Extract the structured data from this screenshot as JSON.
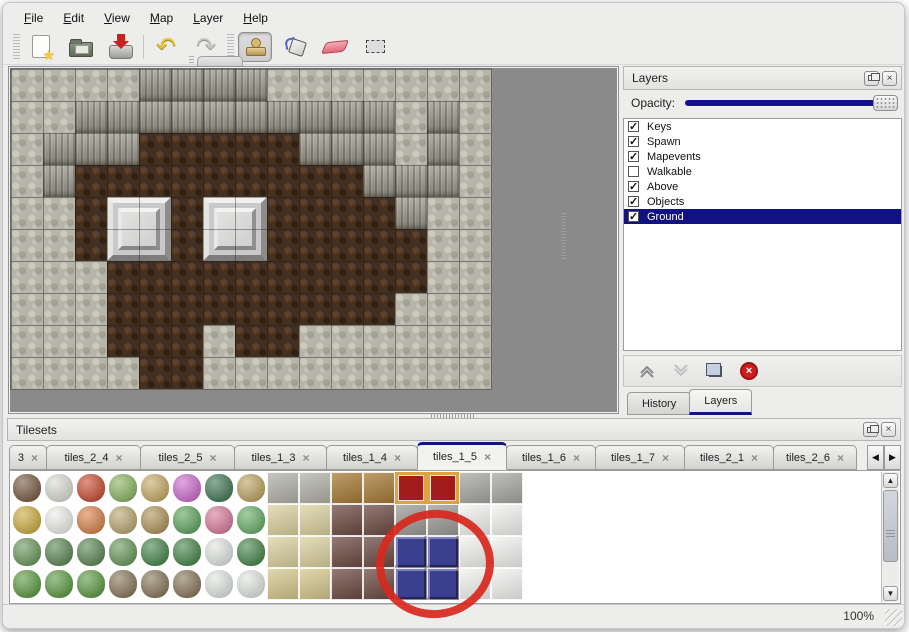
{
  "menu": {
    "items": [
      "File",
      "Edit",
      "View",
      "Map",
      "Layer",
      "Help"
    ]
  },
  "toolbar": {
    "groups": [
      {
        "buttons": [
          {
            "icon": "new-file"
          },
          {
            "icon": "open-folder"
          },
          {
            "icon": "save"
          }
        ]
      },
      {
        "buttons": [
          {
            "icon": "undo"
          },
          {
            "icon": "redo"
          }
        ]
      },
      {
        "buttons": [
          {
            "icon": "stamp",
            "active": true
          },
          {
            "icon": "fill"
          },
          {
            "icon": "eraser"
          },
          {
            "icon": "select"
          }
        ]
      }
    ]
  },
  "layers_panel": {
    "title": "Layers",
    "opacity_label": "Opacity:",
    "opacity_value_pct": 100,
    "layers": [
      {
        "name": "Keys",
        "checked": true,
        "selected": false
      },
      {
        "name": "Spawn",
        "checked": true,
        "selected": false
      },
      {
        "name": "Mapevents",
        "checked": true,
        "selected": false
      },
      {
        "name": "Walkable",
        "checked": false,
        "selected": false
      },
      {
        "name": "Above",
        "checked": true,
        "selected": false
      },
      {
        "name": "Objects",
        "checked": true,
        "selected": false
      },
      {
        "name": "Ground",
        "checked": true,
        "selected": true
      }
    ],
    "buttons": [
      {
        "icon": "move-layer-up",
        "enabled": true
      },
      {
        "icon": "move-layer-down",
        "enabled": false
      },
      {
        "icon": "duplicate-layer",
        "enabled": true
      },
      {
        "icon": "delete-layer",
        "enabled": true
      }
    ],
    "bottom_tabs": [
      {
        "label": "History",
        "active": false
      },
      {
        "label": "Layers",
        "active": true
      }
    ],
    "selected_color": "#111184",
    "opacity_track_color": "#12128c"
  },
  "tilesets_panel": {
    "title": "Tilesets",
    "tabs": [
      {
        "label": "3",
        "active": false,
        "w": 38
      },
      {
        "label": "tiles_2_4",
        "active": false,
        "w": 95
      },
      {
        "label": "tiles_2_5",
        "active": false,
        "w": 95
      },
      {
        "label": "tiles_1_3",
        "active": false,
        "w": 93
      },
      {
        "label": "tiles_1_4",
        "active": false,
        "w": 92
      },
      {
        "label": "tiles_1_5",
        "active": true,
        "w": 90
      },
      {
        "label": "tiles_1_6",
        "active": false,
        "w": 90
      },
      {
        "label": "tiles_1_7",
        "active": false,
        "w": 90
      },
      {
        "label": "tiles_2_1",
        "active": false,
        "w": 90
      },
      {
        "label": "tiles_2_6",
        "active": false,
        "w": 84
      }
    ]
  },
  "statusbar": {
    "zoom": "100%"
  },
  "map": {
    "tile_size": 32,
    "grid": [
      "RRRRCCCCRRRRRRR",
      "RRCCCCCCCCCCRCR",
      "RCCCBBBBBCCCRCR",
      "RCBBBBBBBBBCCCR",
      "RRBBBBBBBBBBCRR",
      "RRBBBBBBBBBBBRR",
      "RRRBBBBBBBBBBRR",
      "RRRBBBBBBBBBRRR",
      "RRRBBBRBBRRRRRR",
      "RRRRBBRRRRRRRRR"
    ],
    "tables": [
      {
        "col": 3,
        "row": 4
      },
      {
        "col": 6,
        "row": 4
      }
    ]
  },
  "tileset": {
    "types": {
      "deadtree": {
        "color": "#6b4a2f",
        "kind": "blob"
      },
      "snowtree": {
        "color": "#d9d9d0",
        "kind": "blob"
      },
      "redflower": {
        "color": "#c33b1e",
        "kind": "blob"
      },
      "stump": {
        "color": "#7fae52",
        "kind": "blob"
      },
      "trunk": {
        "color": "#c2a256",
        "kind": "blob"
      },
      "pinkflower": {
        "color": "#c75fc7",
        "kind": "blob"
      },
      "palmbush": {
        "color": "#2e6b44",
        "kind": "blob"
      },
      "driedplant": {
        "color": "#b79b51",
        "kind": "blob"
      },
      "hay": {
        "color": "#c7a62e",
        "kind": "blob"
      },
      "snowmound": {
        "color": "#eceee8",
        "kind": "blob"
      },
      "orangeflower": {
        "color": "#d4763a",
        "kind": "blob"
      },
      "grasstuft": {
        "color": "#b59f63",
        "kind": "blob"
      },
      "leaves": {
        "color": "#a98a4a",
        "kind": "blob"
      },
      "lilypad": {
        "color": "#4f9d4f",
        "kind": "blob"
      },
      "roses": {
        "color": "#d46f93",
        "kind": "blob"
      },
      "lilypad2": {
        "color": "#59a659",
        "kind": "blob"
      },
      "sprouts": {
        "color": "#5d8f4c",
        "kind": "blob"
      },
      "bush": {
        "color": "#4c7c44",
        "kind": "blob"
      },
      "palmtree": {
        "color": "#357a38",
        "kind": "blob"
      },
      "snowpine": {
        "color": "#dfe4df",
        "kind": "blob"
      },
      "conebush": {
        "color": "#4e9132",
        "kind": "blob"
      },
      "twistedtree": {
        "color": "#7d6a4a",
        "kind": "blob"
      },
      "cobble": {
        "color": "#b3b3aa",
        "kind": "fill"
      },
      "woodtop": {
        "color": "#a87b35",
        "kind": "fill"
      },
      "carpet": {
        "color": "#a31c1c",
        "kind": "carpet"
      },
      "silver": {
        "color": "#a8a8a4",
        "kind": "fill"
      },
      "tanfloor": {
        "color": "#ddd3a2",
        "kind": "fill"
      },
      "tanfloor2": {
        "color": "#d6c98e",
        "kind": "fill"
      },
      "browntable": {
        "color": "#6d4a42",
        "kind": "fill"
      },
      "graylegs": {
        "color": "#9b9b97",
        "kind": "fill"
      },
      "whitetable": {
        "color": "#f4f4f2",
        "kind": "fill"
      },
      "bluetable": {
        "color": "#3a3f8f",
        "kind": "bevel"
      }
    },
    "rows": [
      [
        "deadtree",
        "snowtree",
        "redflower",
        "stump",
        "trunk",
        "pinkflower",
        "palmbush",
        "driedplant",
        "cobble",
        "cobble",
        "woodtop",
        "woodtop",
        "carpet",
        "carpet",
        "silver",
        "silver"
      ],
      [
        "hay",
        "snowmound",
        "orangeflower",
        "grasstuft",
        "leaves",
        "lilypad",
        "roses",
        "lilypad2",
        "tanfloor",
        "tanfloor",
        "browntable",
        "browntable",
        "graylegs",
        "graylegs",
        "whitetable",
        "whitetable"
      ],
      [
        "sprouts",
        "bush",
        "bush",
        "sprouts",
        "palmtree",
        "palmtree",
        "snowpine",
        "palmtree",
        "tanfloor",
        "tanfloor",
        "browntable",
        "browntable",
        "bluetable",
        "bluetable",
        "whitetable",
        "whitetable"
      ],
      [
        "conebush",
        "conebush",
        "conebush",
        "twistedtree",
        "twistedtree",
        "twistedtree",
        "snowpine",
        "snowpine",
        "tanfloor2",
        "tanfloor2",
        "browntable",
        "browntable",
        "bluetable",
        "bluetable",
        "whitetable",
        "whitetable"
      ]
    ]
  },
  "annotation": {
    "shape": "ellipse",
    "color": "#d8281e"
  }
}
